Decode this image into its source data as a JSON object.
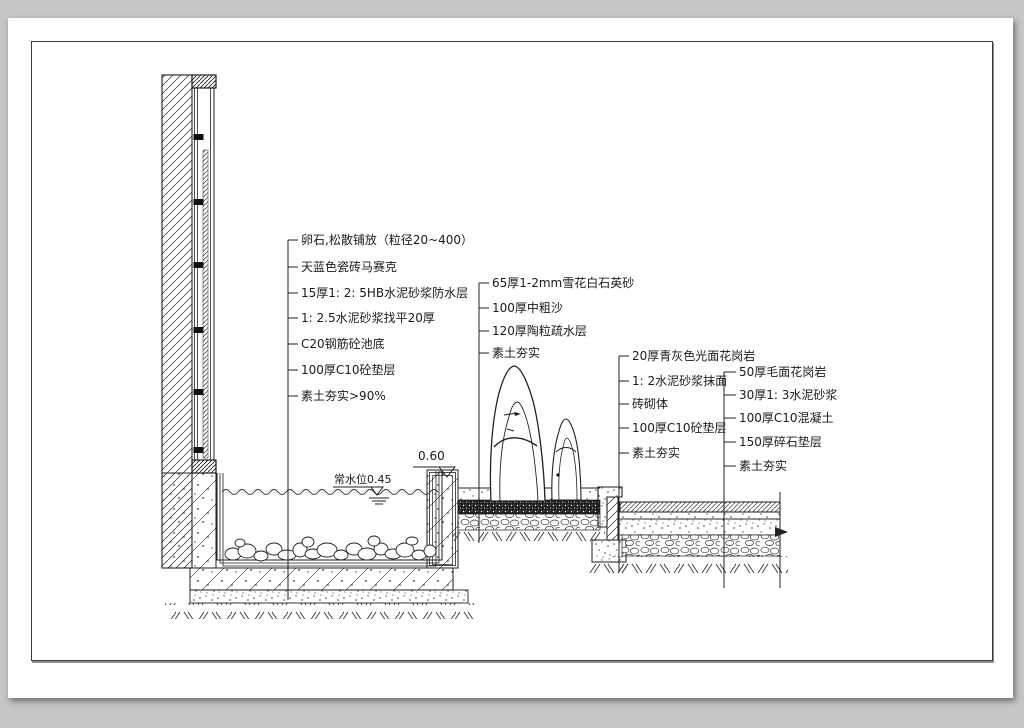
{
  "meta": {
    "background_color": "#c6c6c6",
    "paper_color": "#ffffff",
    "line_color": "#1f1f1f",
    "drawing_type": "水景池壁及铺装做法详图 (construction detail section)"
  },
  "annotations": {
    "left": {
      "items": [
        "卵石,松散铺放（粒径20~400）",
        "天蓝色瓷砖马赛克",
        "15厚1: 2: 5HB水泥砂浆防水层",
        "1: 2.5水泥砂浆找平20厚",
        "C20钢筋砼池底",
        "100厚C10砼垫层",
        "素土夯实>90%"
      ]
    },
    "middle": {
      "items": [
        "65厚1-2mm雪花白石英砂",
        "100厚中粗沙",
        "120厚陶粒疏水层",
        "素土夯实"
      ]
    },
    "right_mid": {
      "items": [
        "20厚青灰色光面花岗岩",
        "1: 2水泥砂浆抹面",
        "砖砌体",
        "100厚C10砼垫层",
        "素土夯实"
      ]
    },
    "right": {
      "items": [
        "50厚毛面花岗岩",
        "30厚1: 3水泥砂浆",
        "100厚C10混凝土",
        "150厚碎石垫层",
        "素土夯实"
      ]
    }
  },
  "markers": {
    "water_level": "常水位0.45",
    "elevation": "0.60"
  }
}
